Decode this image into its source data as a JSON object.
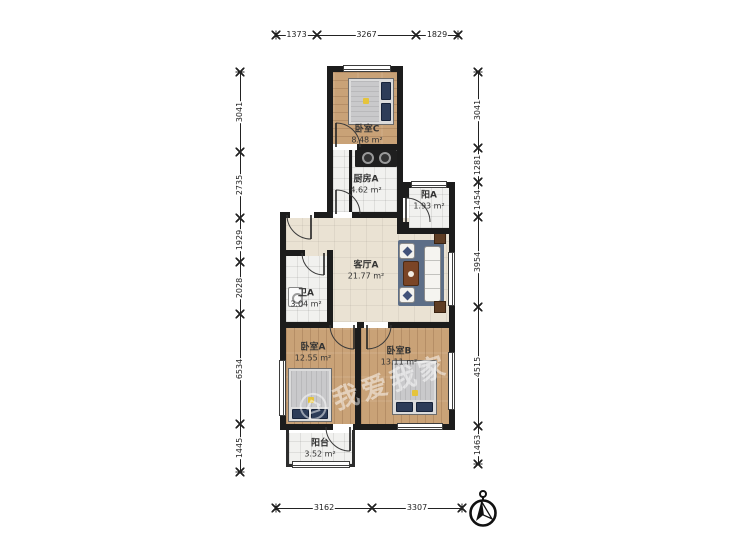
{
  "watermark": {
    "text": "我爱我家"
  },
  "rooms": [
    {
      "id": "bedroom-c",
      "name": "卧室C",
      "area": "8.48 m²"
    },
    {
      "id": "kitchen-a",
      "name": "厨房A",
      "area": "4.62 m²"
    },
    {
      "id": "balcony-a",
      "name": "阳A",
      "area": "1.93 m²"
    },
    {
      "id": "living-a",
      "name": "客厅A",
      "area": "21.77 m²"
    },
    {
      "id": "bath-a",
      "name": "卫A",
      "area": "3.04 m²"
    },
    {
      "id": "bedroom-a",
      "name": "卧室A",
      "area": "12.55 m²"
    },
    {
      "id": "bedroom-b",
      "name": "卧室B",
      "area": "13.11 m²"
    },
    {
      "id": "balcony",
      "name": "阳台",
      "area": "3.52 m²"
    }
  ],
  "dimensions": {
    "top": [
      1373,
      3267,
      1829
    ],
    "bottom": [
      3162,
      3307
    ],
    "left": [
      3041,
      2735,
      1929,
      2028,
      6534,
      1445
    ],
    "right": [
      3041,
      1281,
      1454,
      3954,
      4515,
      1463
    ]
  },
  "colors": {
    "wall": "#1c1c1c",
    "wood_floor": "#c9a277",
    "tile_floor": "#f1f1ef",
    "living_floor": "#eae2d3",
    "rug": "#5d6e87",
    "pillow": "#2d3c58",
    "coffee_table": "#7b4526",
    "accent_pillow": "#e5c43c"
  }
}
